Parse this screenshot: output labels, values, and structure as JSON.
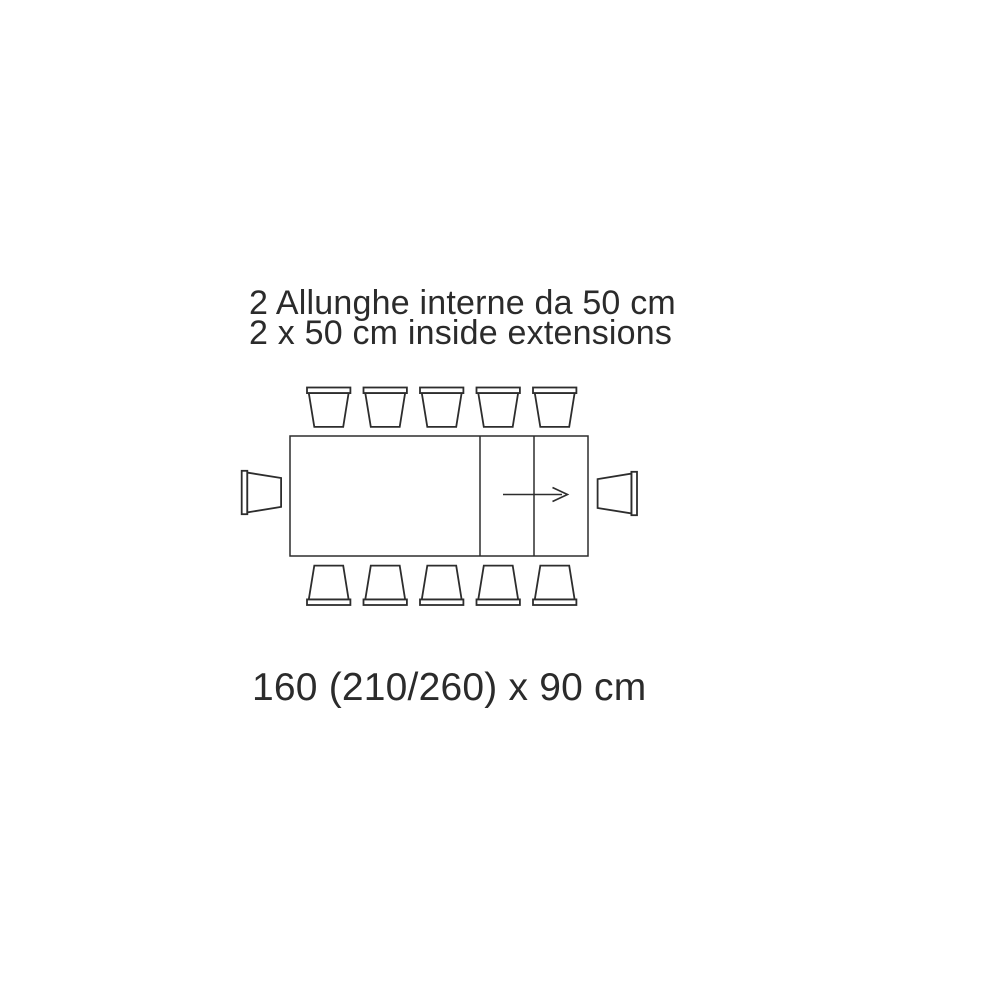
{
  "annotation": {
    "title_line1": "2 Allunghe interne da 50 cm",
    "title_line2": "2 x 50 cm inside extensions",
    "dimensions": "160 (210/260) x 90 cm"
  },
  "colors": {
    "line": "#2d2d2d",
    "text": "#2b2b2b",
    "background": "#ffffff"
  },
  "diagram": {
    "kind": "extending-dining-table-plan-view",
    "table_cm": {
      "closed_length": "160",
      "extended_lengths": "210/260",
      "width": "90",
      "extension_each": "50",
      "extension_count": 2
    },
    "chairs": {
      "top": 5,
      "bottom": 5,
      "left": 1,
      "right": 1,
      "total": 12
    },
    "arrow_direction": "right"
  }
}
